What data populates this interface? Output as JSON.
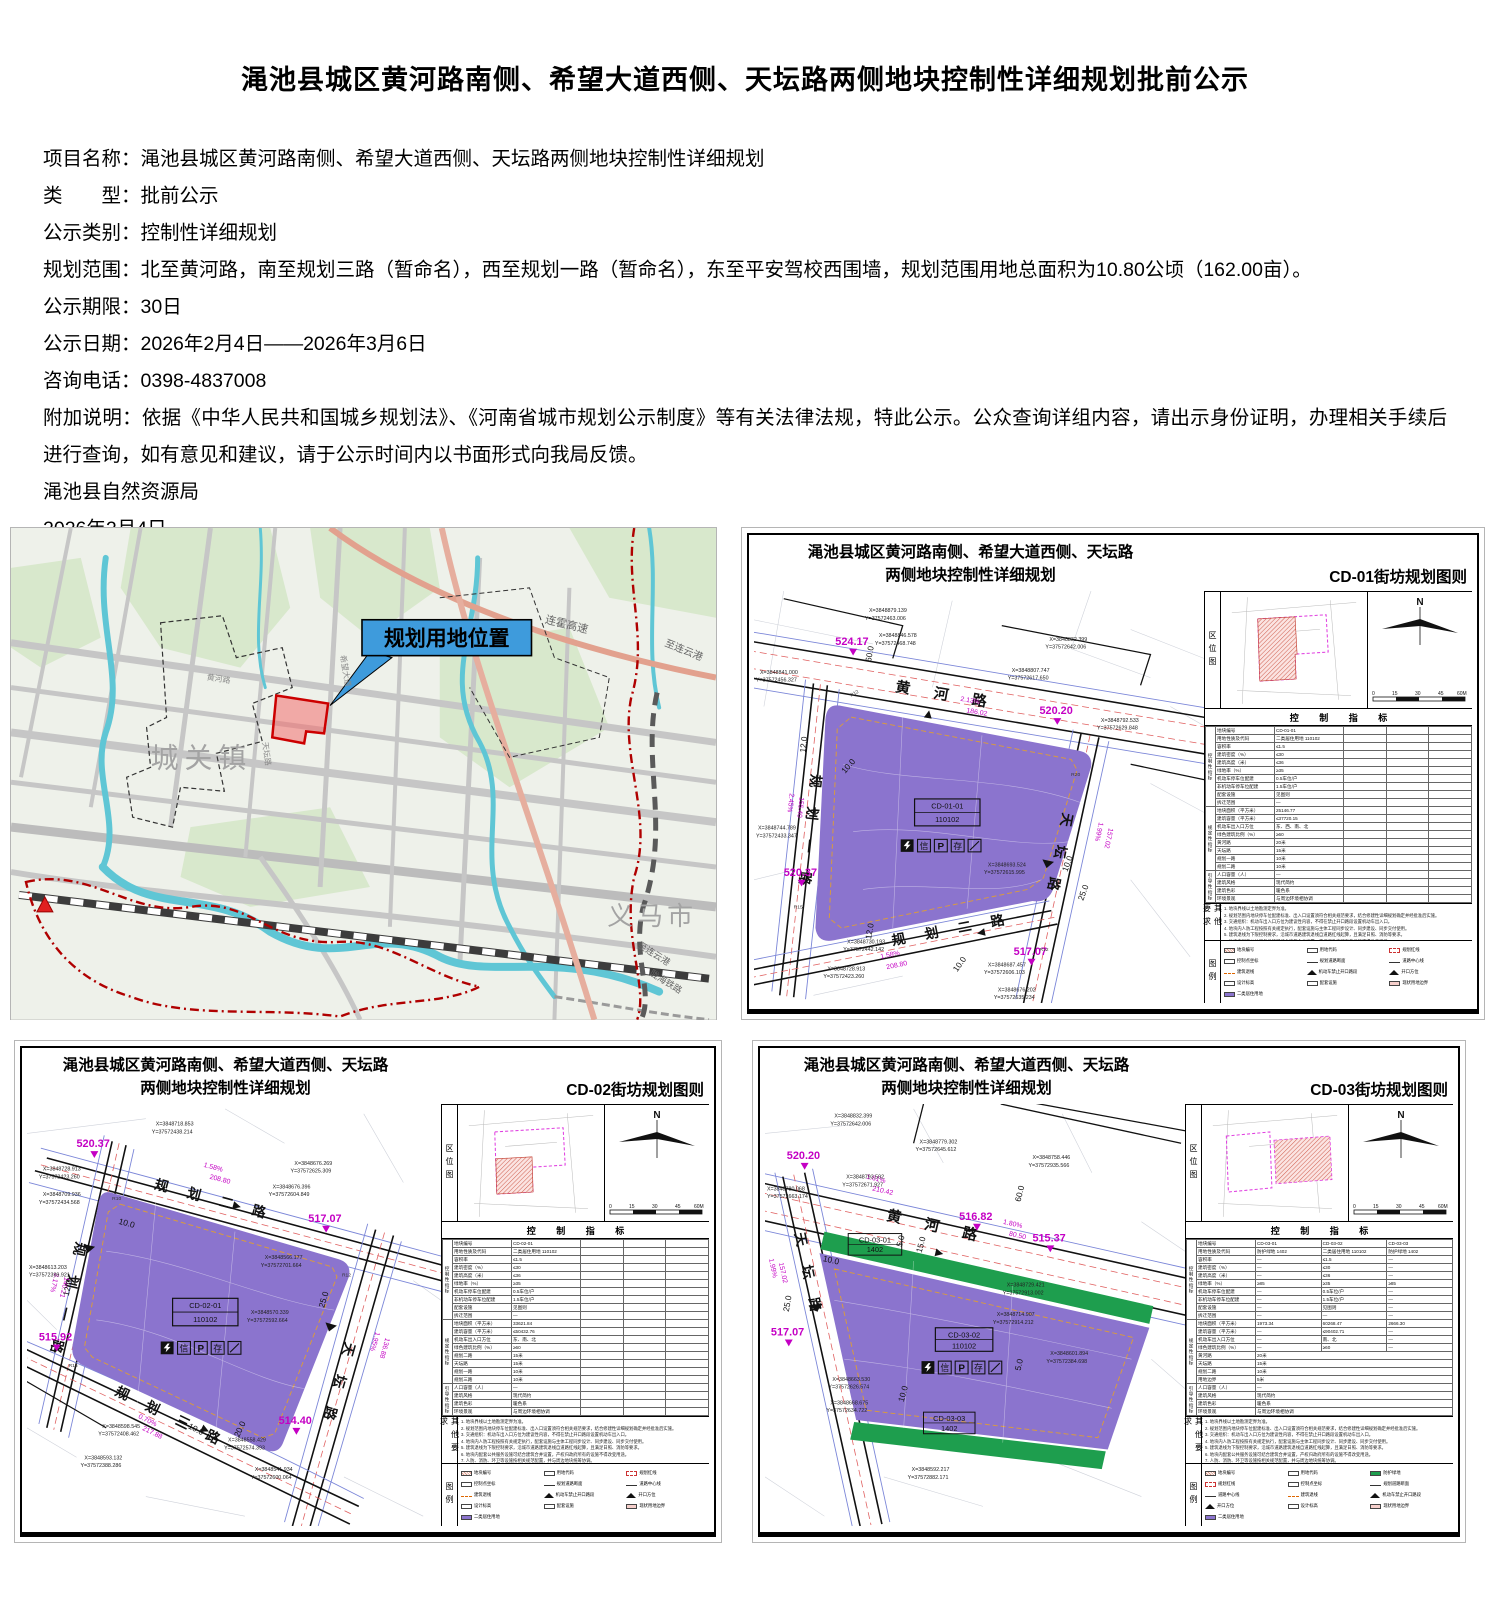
{
  "notice": {
    "title": "渑池县城区黄河路南侧、希望大道西侧、天坛路两侧地块控制性详细规划批前公示",
    "fields": [
      {
        "label": "项目名称：",
        "value": "渑池县城区黄河路南侧、希望大道西侧、天坛路两侧地块控制性详细规划"
      },
      {
        "label": "类　　型：",
        "value": "批前公示"
      },
      {
        "label": "公示类别：",
        "value": "控制性详细规划"
      },
      {
        "label": "规划范围：",
        "value": "北至黄河路，南至规划三路（暂命名），西至规划一路（暂命名），东至平安驾校西围墙，规划范围用地总面积为10.80公顷（162.00亩）。"
      },
      {
        "label": "公示期限：",
        "value": "30日"
      },
      {
        "label": "公示日期：",
        "value": "2026年2月4日——2026年3月6日"
      },
      {
        "label": "咨询电话：",
        "value": "0398-4837008"
      },
      {
        "label": "附加说明：",
        "value": "依据《中华人民共和国城乡规划法》、《河南省城市规划公示制度》等有关法律法规，特此公示。公众查询详组内容，请出示身份证明，办理相关手续后进行查询，如有意见和建议，请于公示时间内以书面形式向我局反馈。"
      }
    ],
    "signature": "渑池县自然资源局",
    "date": "2026年2月4日"
  },
  "location_map": {
    "callout": "规划用地位置",
    "town": "城关镇",
    "city": "义马市",
    "highway": "连霍高速",
    "to_port1": "至连云港",
    "to_port2": "至连云港",
    "railway": "陇海铁路",
    "road1": "黄河路",
    "road2": "希望大道",
    "road3": "天坛路"
  },
  "shared": {
    "inset_label": "区位图",
    "north": "N",
    "scale": [
      "0",
      "15",
      "30",
      "45",
      "60M"
    ],
    "table_title": "控 制 指 标",
    "sections": [
      "控制性指标",
      "规定性指标",
      "引导性指标"
    ],
    "notes_label": "其他要求",
    "legend_label": "图例",
    "row_labels": [
      "地块编号",
      "用地性质及代码",
      "容积率",
      "建筑密度（%）",
      "建筑高度（米）",
      "绿地率（%）",
      "机动车停车位配建",
      "非机动车停车位配建",
      "配套设施",
      "拆迁范围",
      "地块面积（平方米）",
      "建筑容量（平方米）",
      "机动车出入口方位",
      "绿色建筑比例（%）",
      "人口容量（人）",
      "建筑风格",
      "建筑色彩",
      "环境景观"
    ],
    "notes": [
      "1. 地块界线以土地勘测定界为准。",
      "2. 规划范围内地块停车位配建标准、出入口设置须符合相关规范要求，结合修建性详细规划确定并经批准后实施。",
      "3. 交通组织：机动车出入口方位为建议性内容，不得在禁止开口路段设置机动车出入口。",
      "4. 地块内人防工程按照有关规定执行，配套设施与主体工程同步设计、同步建设、同步交付使用。",
      "5. 建筑退线为下限控制要求，沿城市道路建筑退线自道路红线起算，且满足日照、消防等要求。",
      "6. 地块内配套公共服务设施可结合建筑合并设置，产权归政府所有的设施不得改变用途。",
      "7. 人防、消防、环卫等设施按相关规范配置，并与周边地块统筹协调。",
      "8. 水电气热等市政管线综合以专项规划为准，按相关标准预留接入条件。",
      "9. 未尽事宜按照国家、省、市有关法律法规及技术规范执行。"
    ],
    "legend_items": [
      "地块编号",
      "用地代码",
      "规划红线",
      "控制点坐标",
      "规划道路断面",
      "道路中心线",
      "建筑退线",
      "机动车禁止开口路段",
      "开口方位",
      "设计标高",
      "配套设施",
      "现状用地边界",
      "二类居住用地",
      "防护绿地"
    ],
    "icons": {
      "xin": "信",
      "p": "P",
      "cun": "存"
    }
  },
  "cd01": {
    "title1": "渑池县城区黄河路南侧、希望大道西侧、天坛路",
    "title2": "两侧地块控制性详细规划",
    "sheet": "CD-01街坊规划图则",
    "parcel": {
      "code": "CD-01-01",
      "use": "110102"
    },
    "roads": {
      "north": "黄 河 路",
      "west": "规 划 一 路",
      "east": "天 坛 路",
      "south": "规 划 二 路"
    },
    "elev": [
      "524.17",
      "520.20",
      "520.37",
      "517.07"
    ],
    "slopes": [
      {
        "p": "2.13%",
        "l": "186.02"
      },
      {
        "p": "2.45%",
        "l": "155.40"
      },
      {
        "p": "1.58%",
        "l": "208.80"
      },
      {
        "p": "1.99%",
        "l": "157.02"
      }
    ],
    "dims": [
      "60.0",
      "12.0",
      "10.0",
      "10.0",
      "25.0",
      "12.0",
      "10.0"
    ],
    "radii": [
      "R12",
      "R20",
      "R15",
      "R12"
    ],
    "coords": [
      {
        "x": "X=3848879.139",
        "y": "Y=37572463.006"
      },
      {
        "x": "X=3848846.578",
        "y": "Y=37572468.748"
      },
      {
        "x": "X=3848841.000",
        "y": "Y=37572456.327"
      },
      {
        "x": "X=3848832.399",
        "y": "Y=37572642.006"
      },
      {
        "x": "X=3848807.747",
        "y": "Y=37572617.650"
      },
      {
        "x": "X=3848792.533",
        "y": "Y=37572629.848"
      },
      {
        "x": "X=3848744.789",
        "y": "Y=37572433.347"
      },
      {
        "x": "X=3848693.524",
        "y": "Y=37572615.995"
      },
      {
        "x": "X=3848730.193",
        "y": "Y=37572442.142"
      },
      {
        "x": "X=3848728.913",
        "y": "Y=37572423.260"
      },
      {
        "x": "X=3848687.457",
        "y": "Y=37572606.103"
      },
      {
        "x": "X=3848676.202",
        "y": "Y=37572635.234"
      }
    ],
    "table": [
      "CD-01-01",
      "二类居住用地 110102",
      "≤1.5",
      "≤30",
      "≤36",
      "≥35",
      "0.5车位/户",
      "1.5车位/户",
      "见图则",
      "—",
      "25146.77",
      "≤37720.15",
      "东、西、南、北",
      "≥60",
      "—",
      "现代简约",
      "暖色系",
      "与周边环境相协调"
    ],
    "retreat": [
      {
        "r": "黄河路",
        "v": "20米"
      },
      {
        "r": "天坛路",
        "v": "15米"
      },
      {
        "r": "规划一路",
        "v": "10米"
      },
      {
        "r": "规划二路",
        "v": "10米"
      }
    ]
  },
  "cd02": {
    "title1": "渑池县城区黄河路南侧、希望大道西侧、天坛路",
    "title2": "两侧地块控制性详细规划",
    "sheet": "CD-02街坊规划图则",
    "parcel": {
      "code": "CD-02-01",
      "use": "110102"
    },
    "roads": {
      "north": "规 划 二 路",
      "west": "规 划 一 路",
      "east": "天 坛 路",
      "south": "规 划 三 路"
    },
    "elev": [
      "520.37",
      "517.07",
      "515.92",
      "514.40"
    ],
    "slopes": [
      {
        "p": "1.58%",
        "l": "208.80"
      },
      {
        "p": "3.17%",
        "l": "140.21"
      },
      {
        "p": "0.70%",
        "l": "217.88"
      },
      {
        "p": "1.95%",
        "l": "136.88"
      }
    ],
    "dims": [
      "12.0",
      "10.0",
      "25.0",
      "20.0",
      "10.0"
    ],
    "radii": [
      "R10",
      "R12",
      "R15"
    ],
    "coords": [
      {
        "x": "X=3848718.853",
        "y": "Y=37572438.214"
      },
      {
        "x": "X=3848728.913",
        "y": "Y=37572423.260"
      },
      {
        "x": "X=3848709.936",
        "y": "Y=37572434.568"
      },
      {
        "x": "X=3848676.269",
        "y": "Y=37572625.309"
      },
      {
        "x": "X=3848676.396",
        "y": "Y=37572604.849"
      },
      {
        "x": "X=3848613.203",
        "y": "Y=37572399.921"
      },
      {
        "x": "X=3848566.177",
        "y": "Y=37572701.664"
      },
      {
        "x": "X=3848570.339",
        "y": "Y=37572592.664"
      },
      {
        "x": "X=3848598.545",
        "y": "Y=37572408.462"
      },
      {
        "x": "X=3848593.132",
        "y": "Y=37572388.286"
      },
      {
        "x": "X=3848558.429",
        "y": "Y=37572574.393"
      },
      {
        "x": "X=3848541.934",
        "y": "Y=37572600.064"
      }
    ],
    "table": [
      "CD-02-01",
      "二类居住用地 110102",
      "≤1.5",
      "≤30",
      "≤36",
      "≥35",
      "0.5车位/户",
      "1.5车位/户",
      "见图则",
      "—",
      "33621.84",
      "≤50432.76",
      "东、南、北",
      "≥60",
      "—",
      "现代简约",
      "暖色系",
      "与周边环境相协调"
    ],
    "retreat": [
      {
        "r": "规划二路",
        "v": "15米"
      },
      {
        "r": "天坛路",
        "v": "15米"
      },
      {
        "r": "规划一路",
        "v": "10米"
      },
      {
        "r": "规划三路",
        "v": "10米"
      }
    ]
  },
  "cd03": {
    "title1": "渑池县城区黄河路南侧、希望大道西侧、天坛路",
    "title2": "两侧地块控制性详细规划",
    "sheet": "CD-03街坊规划图则",
    "parcels": [
      {
        "code": "CD-03-01",
        "use": "1402"
      },
      {
        "code": "CD-03-02",
        "use": "110102"
      },
      {
        "code": "CD-03-03",
        "use": "1402"
      }
    ],
    "roads": {
      "north": "黄 河 路",
      "west": "天 坛 路"
    },
    "elev": [
      "520.20",
      "516.82",
      "515.37",
      "517.07"
    ],
    "slopes": [
      {
        "p": "1.61%",
        "l": "210.42"
      },
      {
        "p": "1.80%",
        "l": "80.50"
      },
      {
        "p": "1.99%",
        "l": "157.02"
      }
    ],
    "dims": [
      "60.0",
      "10.0",
      "25.0",
      "5.0",
      "15.0",
      "10.0",
      "5.0"
    ],
    "coords": [
      {
        "x": "X=3848832.399",
        "y": "Y=37572642.006"
      },
      {
        "x": "X=3848779.302",
        "y": "Y=37572645.612"
      },
      {
        "x": "X=3848758.446",
        "y": "Y=37572935.566"
      },
      {
        "x": "X=3848780.068",
        "y": "Y=37572663.174"
      },
      {
        "x": "X=3848793.592",
        "y": "Y=37572671.927"
      },
      {
        "x": "X=3848729.421",
        "y": "Y=37572913.002"
      },
      {
        "x": "X=3848714.907",
        "y": "Y=37572914.212"
      },
      {
        "x": "X=3848663.530",
        "y": "Y=37572626.574"
      },
      {
        "x": "X=3848668.675",
        "y": "Y=37572634.722"
      },
      {
        "x": "X=3848601.894",
        "y": "Y=37572384.698"
      },
      {
        "x": "X=3848592.217",
        "y": "Y=37572882.171"
      }
    ],
    "table": [
      [
        "CD-03-01",
        "CD-03-02",
        "CD-03-03"
      ],
      [
        "防护绿地 1402",
        "二类居住用地 110102",
        "防护绿地 1402"
      ],
      [
        "—",
        "≤1.5",
        "—"
      ],
      [
        "—",
        "≤30",
        "—"
      ],
      [
        "—",
        "≤36",
        "—"
      ],
      [
        "≥85",
        "≥35",
        "≥85"
      ],
      [
        "—",
        "0.5车位/户",
        "—"
      ],
      [
        "—",
        "1.5车位/户",
        "—"
      ],
      [
        "—",
        "见图则",
        "—"
      ],
      [
        "—",
        "—",
        "—"
      ],
      [
        "1973.34",
        "60268.47",
        "2666.30"
      ],
      [
        "—",
        "≤90402.71",
        "—"
      ],
      [
        "—",
        "南、北",
        "—"
      ],
      [
        "—",
        "≥60",
        "—"
      ]
    ],
    "table_guide": [
      "—",
      "现代简约",
      "暖色系",
      "与周边环境相协调"
    ],
    "retreat": [
      {
        "r": "黄河路",
        "v": "20米"
      },
      {
        "r": "天坛路",
        "v": "15米"
      },
      {
        "r": "规划二路",
        "v": "10米"
      },
      {
        "r": "用地边界",
        "v": "5米"
      }
    ]
  }
}
